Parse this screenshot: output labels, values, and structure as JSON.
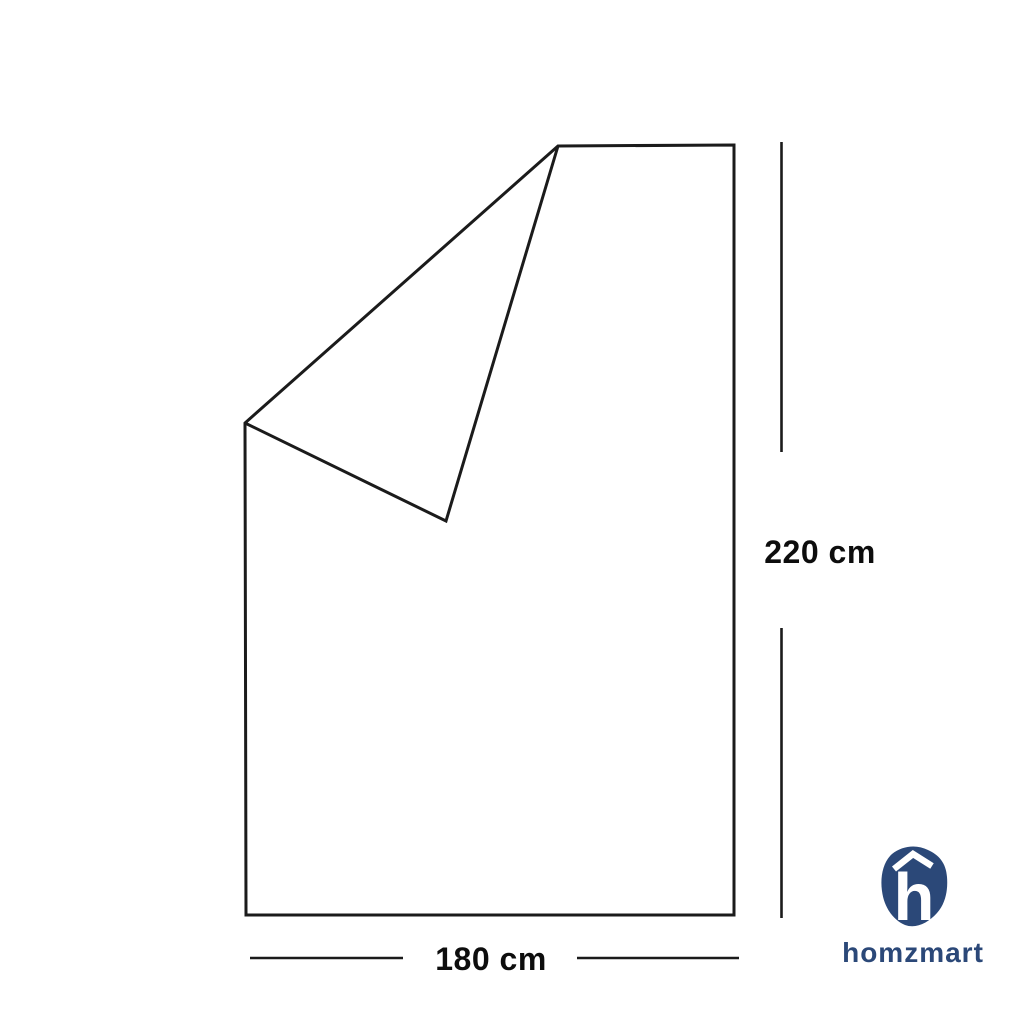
{
  "diagram": {
    "subject": "blanket outline with folded-back top corner",
    "line_color": "#1b1b1b",
    "fill_color": "#ffffff",
    "height_label": "220 cm",
    "width_label": "180 cm",
    "height_value": 220,
    "width_value": 180,
    "unit": "cm"
  },
  "logo": {
    "brand": "homzmart",
    "color": "#2b4878",
    "icon_letter": "h",
    "icon_color_text": "#ffffff"
  }
}
